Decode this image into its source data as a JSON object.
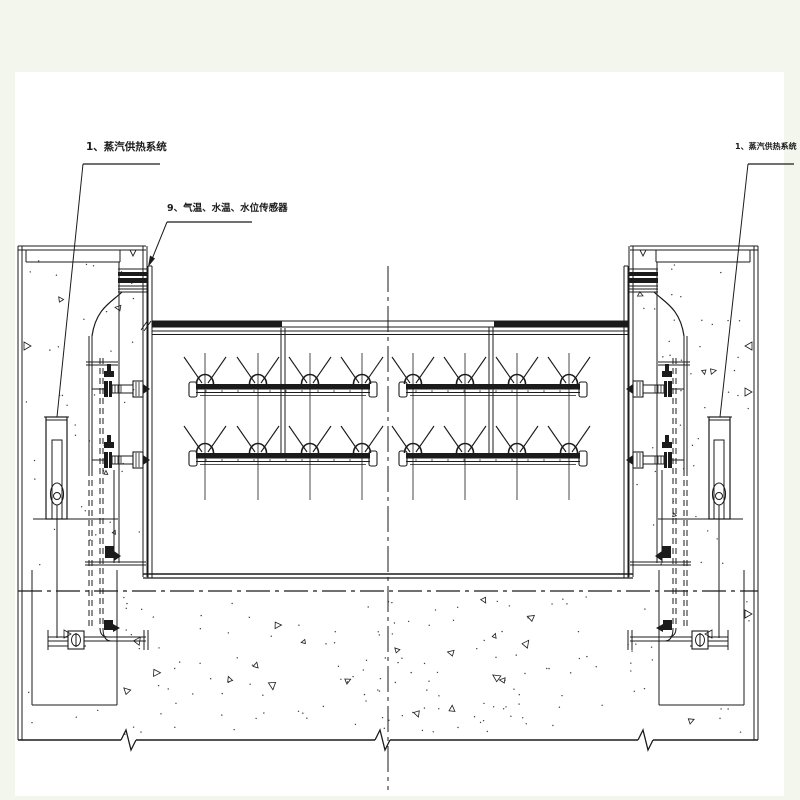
{
  "drawing": {
    "labels": {
      "left_system": "1、蒸汽供热系统",
      "sensors": "9、气温、水温、水位传感器",
      "right_system": "1、蒸汽供热系统"
    },
    "colors": {
      "ink": "#1b1b1b",
      "paper": "#ffffff",
      "page_margin": "#f3f6ec"
    }
  }
}
